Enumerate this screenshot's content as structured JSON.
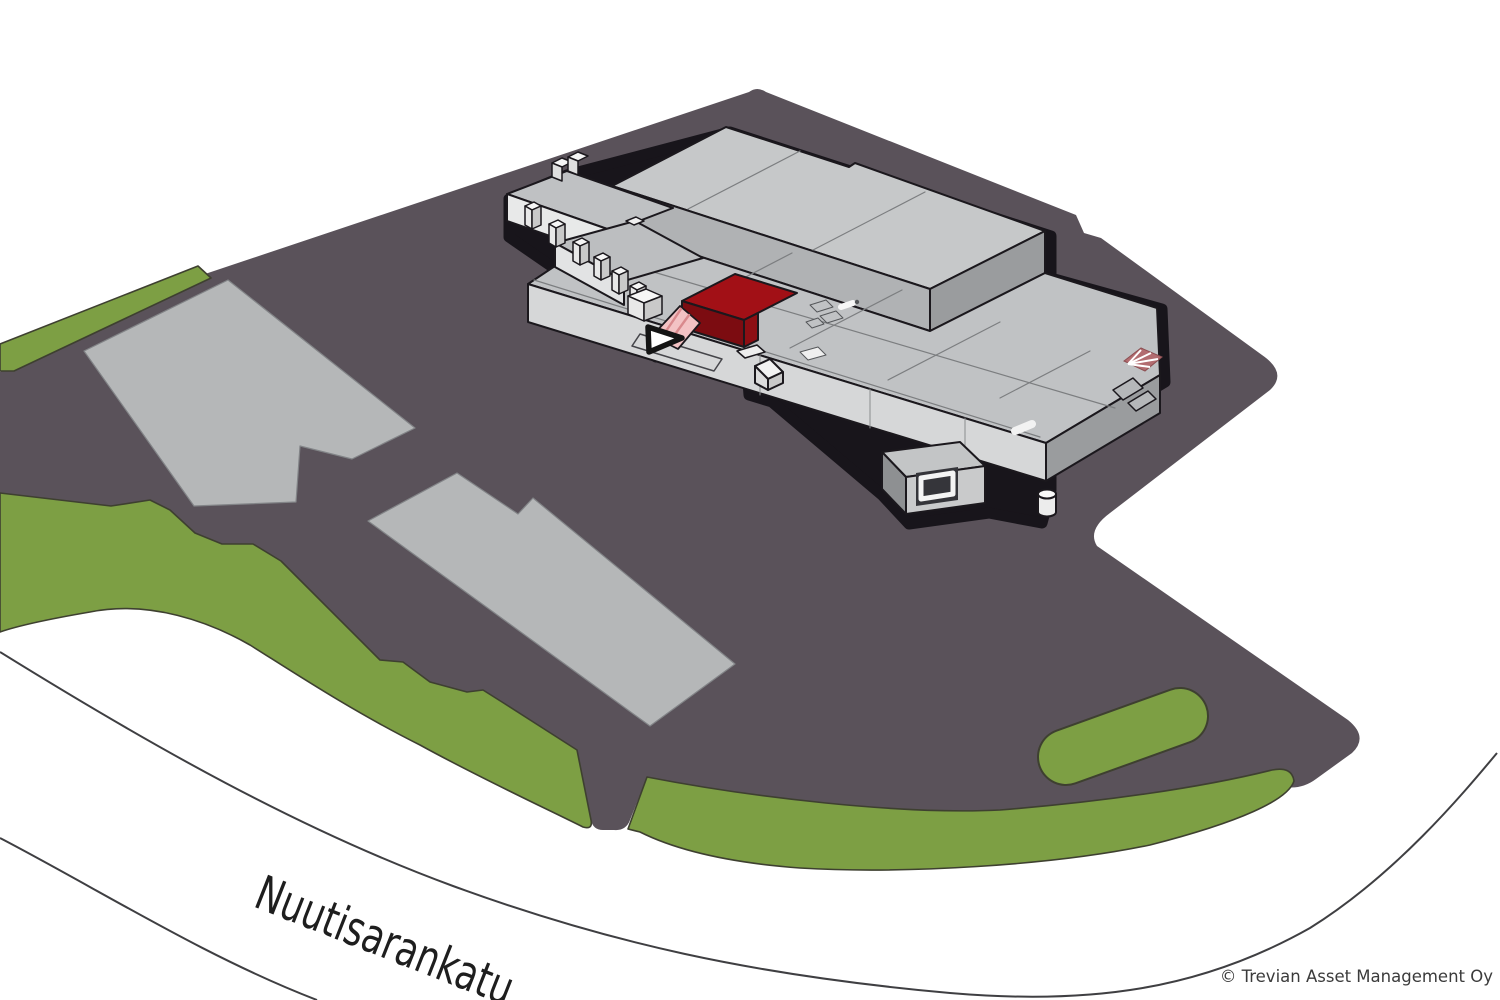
{
  "map": {
    "street_label": "Nuutisarankatu",
    "copyright": "© Trevian Asset Management Oy",
    "colors": {
      "background": "#ffffff",
      "asphalt_lot": "#5a525a",
      "grass": "#7d9f44",
      "grass_outline": "#3e4030",
      "parking_pad": "#b5b7b8",
      "building_roof": "#c6c8c9",
      "building_roof_low": "#c0c2c4",
      "building_wall_dark": "#9a9c9e",
      "building_wall_light": "#d6d7d8",
      "outline_black": "#1b181d",
      "highlight_roof_red": "#a21016",
      "highlight_front_red": "#7c0c11",
      "canopy_pink": "#f3c2c4",
      "canopy_stripe": "#d9898d",
      "flag_marker_pink": "#b26c70",
      "road_line": "#3f3f42",
      "arrow_marker": "#ffffff"
    },
    "markers": [
      {
        "name": "entrance-arrow-marker",
        "meaning": "points to highlighted unit entrance"
      },
      {
        "name": "flag-ground-marker",
        "meaning": "ground marking at east corner"
      },
      {
        "name": "highlighted-unit",
        "meaning": "red highlighted lease unit of warehouse"
      }
    ]
  }
}
